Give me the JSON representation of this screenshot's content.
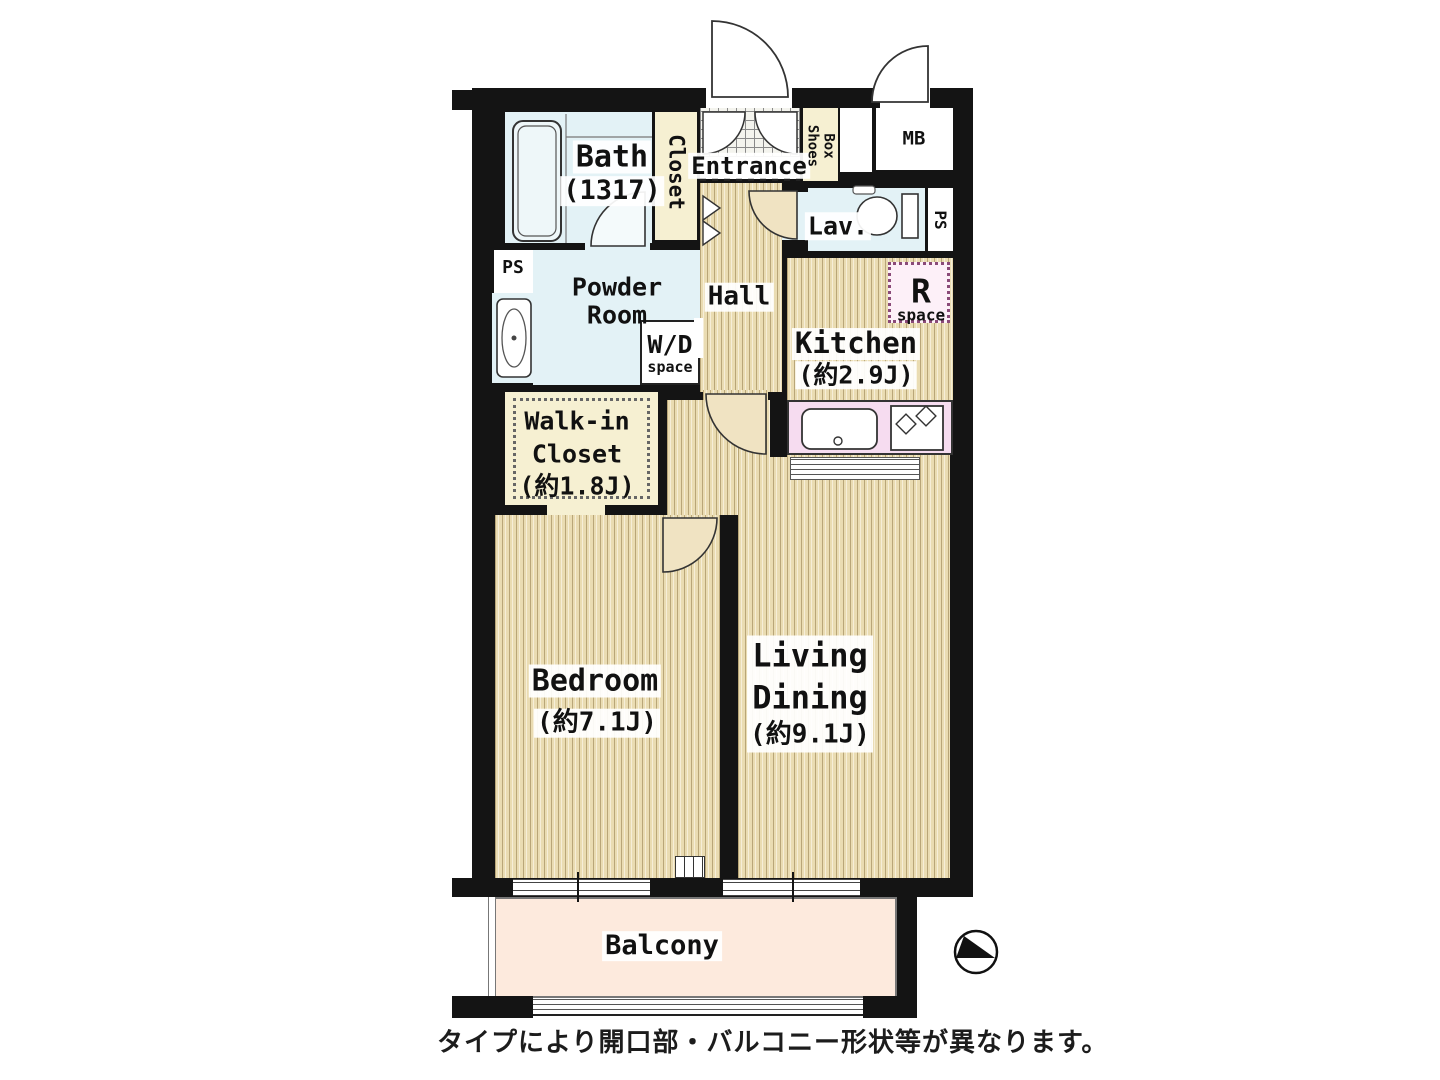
{
  "colors": {
    "wall": "#141414",
    "floor_beige": "#eadcb2",
    "floor_stripe": "#b9a678",
    "water_blue": "#e3f2f6",
    "closet_cream": "#f6f0d2",
    "counter_pink": "#f6dcf0",
    "r_space_pink": "#fdf0f8",
    "balcony_peach": "#fdeadd"
  },
  "labels": {
    "bath": {
      "name": "Bath",
      "size": "(1317)"
    },
    "closet": {
      "name": "Closet"
    },
    "entrance": {
      "name": "Entrance"
    },
    "shoes_box": {
      "left_col": "Shoes",
      "right_col": "Box"
    },
    "mb": {
      "name": "MB"
    },
    "lav": {
      "name": "Lav."
    },
    "ps_right": {
      "name": "PS"
    },
    "ps_left": {
      "name": "PS"
    },
    "powder_room": {
      "line1": "Powder",
      "line2": "Room"
    },
    "wd_space": {
      "line1": "W/D",
      "line2": "space"
    },
    "hall": {
      "name": "Hall"
    },
    "kitchen": {
      "name": "Kitchen",
      "size": "(約2.9J)"
    },
    "r_space": {
      "line1": "R",
      "line2": "space"
    },
    "walk_in_closet": {
      "line1": "Walk-in",
      "line2": "Closet",
      "size": "(約1.8J)"
    },
    "bedroom": {
      "name": "Bedroom",
      "size": "(約7.1J)"
    },
    "living_dining": {
      "line1": "Living",
      "line2": "Dining",
      "size": "(約9.1J)"
    },
    "balcony": {
      "name": "Balcony"
    }
  },
  "caption": "タイプにより開口部・バルコニー形状等が異なります。"
}
